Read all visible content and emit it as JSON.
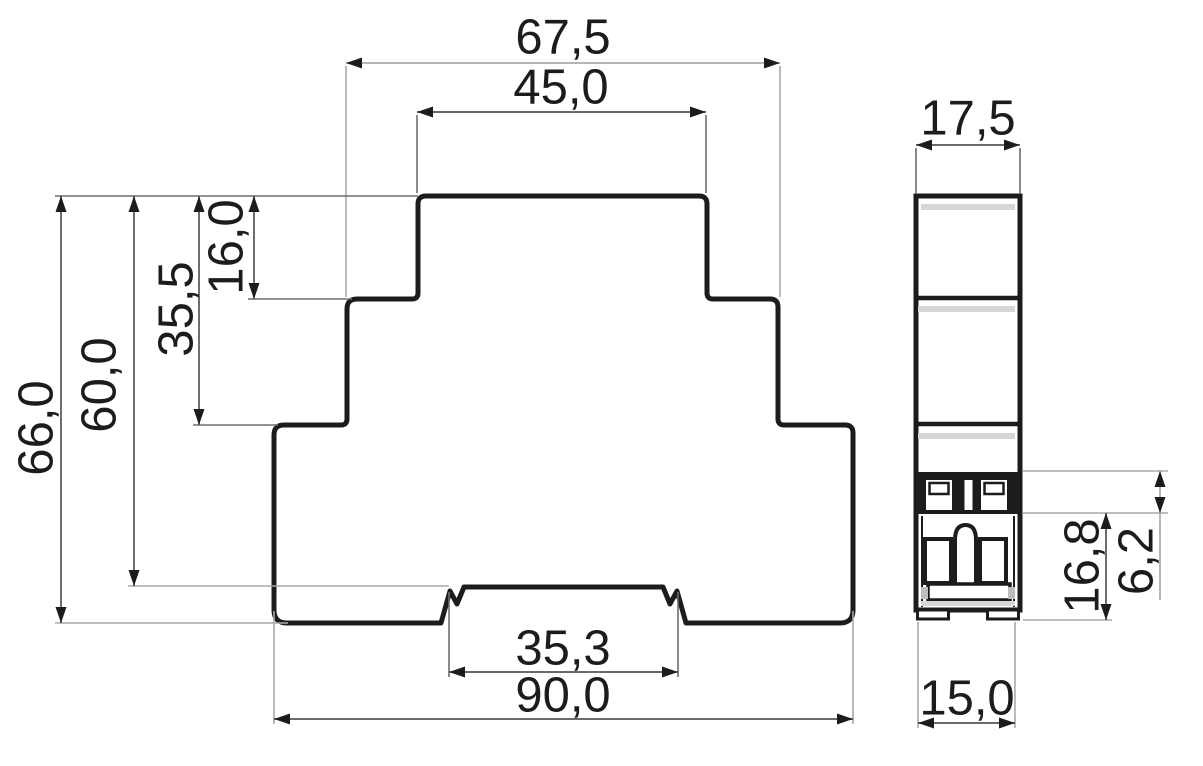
{
  "front": {
    "d67_5": "67,5",
    "d45_0": "45,0",
    "d16_0": "16,0",
    "d35_5": "35,5",
    "d60_0": "60,0",
    "d66_0": "66,0",
    "d35_3": "35,3",
    "d90_0": "90,0"
  },
  "side": {
    "d17_5": "17,5",
    "d6_2": "6,2",
    "d16_8": "16,8",
    "d15_0": "15,0"
  },
  "colors": {
    "outline": "#1c1c1c",
    "dim_line": "#555555",
    "ext_line_gray": "#a9a9a9",
    "ext_line_dark": "#6e6e6e",
    "accent_band": "#d6d6d6",
    "background": "#ffffff"
  }
}
